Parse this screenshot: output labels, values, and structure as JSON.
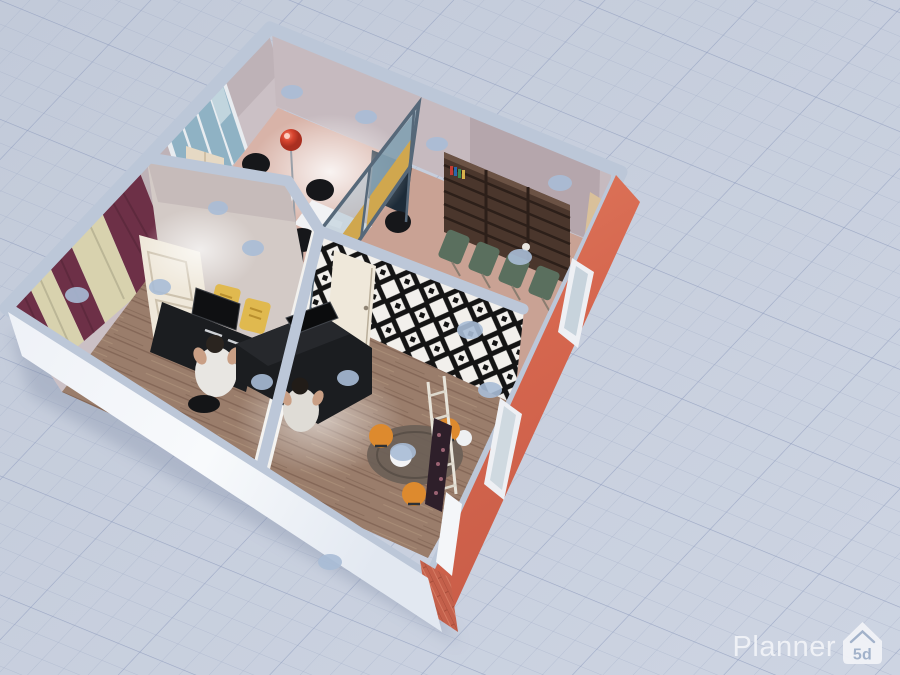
{
  "app": {
    "name": "Planner 5D",
    "watermark": {
      "brand": "Planner",
      "logo_text": "5d",
      "logo_icon": "house-icon"
    }
  },
  "viewport": {
    "width": 900,
    "height": 675,
    "mode": "3D dollhouse floor-plan render",
    "ground": "grid paper plane"
  },
  "scene": {
    "description": "Cutaway perspective render of a four-room office suite",
    "rooms": [
      {
        "name": "office-top",
        "floor_color_key": "floor_pink",
        "items": [
          "folding-window-blue-glass",
          "red-floor-lamp",
          "white-desk",
          "white-desk",
          "black-office-chairs",
          "beige-wardrobe",
          "glass-partition-mustard-panels"
        ]
      },
      {
        "name": "meeting-room-right",
        "floor_color_key": "floor_tan",
        "items": [
          "dark-brown-bookshelf-wall",
          "green-chair-row",
          "teal-reception-desk",
          "beige-door",
          "navy-cabinet"
        ]
      },
      {
        "name": "studio-left",
        "floor_color_key": "floor_wood",
        "items": [
          "burgundy-cream-curtains",
          "window",
          "white-panel-door",
          "black-desk-with-monitor",
          "seated-person",
          "yellow-chairs"
        ]
      },
      {
        "name": "lounge-center",
        "floor_color_key": "floor_wood",
        "items": [
          "black-white-geometric-accent-wall",
          "white-door",
          "black-l-desk-with-laptop",
          "seated-person",
          "orange-stools",
          "round-white-tables",
          "gray-rug",
          "bottle-rack",
          "ladder-shelf"
        ]
      }
    ],
    "exterior": {
      "right_wall": "red brick with windows and white door",
      "bottom_wall": "white",
      "wall_tops": "light blue-gray caps"
    },
    "lighting": {
      "ceiling_spots": "light blue discs",
      "pools": "warm white light pools"
    }
  },
  "colors": {
    "background": "#c7cfdd",
    "grid_minor": "#a4afc9",
    "grid_major": "#8d9bbd",
    "wall_cap": "#bcc7d8",
    "wall_interior": "#c6babf",
    "wall_interior_dark": "#a8969c",
    "wall_white": "#f4f6fa",
    "wall_red": "#d56a52",
    "brick_red": "#c4604b",
    "floor_pink": "#d8b3a8",
    "floor_tan": "#c9a294",
    "floor_wood": "#9a7d6b",
    "accent_black": "#141414",
    "accent_white": "#f2f0ec",
    "curtain_burgundy": "#6d3047",
    "curtain_cream": "#d8d2ae",
    "glass_blue": "#8fb2c4",
    "partition_glass": "#a9c0cd",
    "partition_yellow": "#d0a74e",
    "partition_frame": "#566879",
    "chair_green": "#5a6f5e",
    "desk_teal": "#122b33",
    "desk_teal_edge": "#3e8a7f",
    "shelf_brown": "#4a362c",
    "stool_orange": "#dd8a2e",
    "lamp_red": "#d8452f",
    "door_cream": "#d9c09a",
    "door_white": "#efe8da",
    "desk_black": "#1b1d20",
    "chair_black": "#16171a",
    "chair_yellow": "#e0b94f",
    "rug_gray": "#6b6057",
    "ceiling_spot": "#a9bdd6",
    "watermark_text": "#f2f4f8",
    "watermark_glyph": "#9fb0c9"
  }
}
